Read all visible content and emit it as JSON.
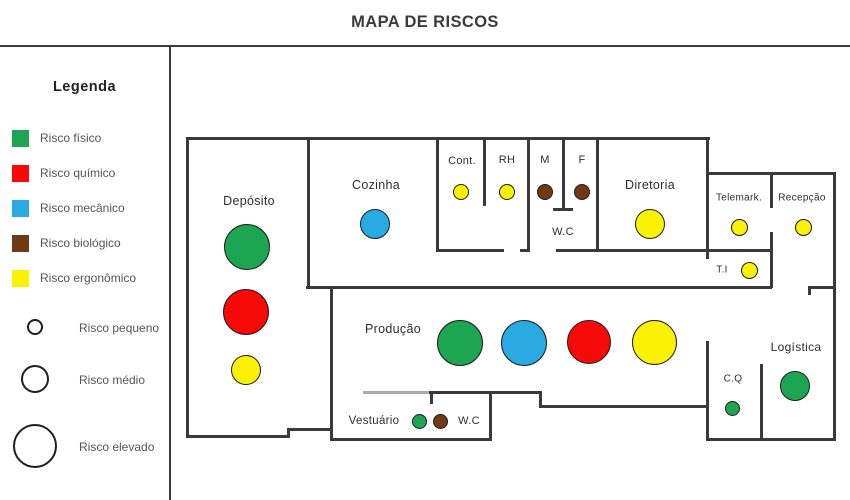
{
  "title": "MAPA DE RISCOS",
  "legend": {
    "heading": "Legenda",
    "risk_types": [
      {
        "id": "fisico",
        "label": "Risco físico",
        "color": "#1ea551"
      },
      {
        "id": "quimico",
        "label": "Risco químico",
        "color": "#f60909"
      },
      {
        "id": "mecanico",
        "label": "Risco mecânico",
        "color": "#29abe2"
      },
      {
        "id": "biologico",
        "label": "Risco biológico",
        "color": "#6f3a14"
      },
      {
        "id": "ergonomico",
        "label": "Risco ergonômico",
        "color": "#fbf104"
      }
    ],
    "risk_sizes": [
      {
        "id": "pequeno",
        "label": "Risco pequeno"
      },
      {
        "id": "medio",
        "label": "Risco médio"
      },
      {
        "id": "elevado",
        "label": "Risco elevado"
      }
    ]
  },
  "map": {
    "rooms": [
      {
        "id": "deposito",
        "label": "Depósito",
        "risks": [
          {
            "type": "fisico",
            "size": "elevado"
          },
          {
            "type": "quimico",
            "size": "elevado"
          },
          {
            "type": "ergonomico",
            "size": "medio"
          }
        ]
      },
      {
        "id": "cozinha",
        "label": "Cozinha",
        "risks": [
          {
            "type": "mecanico",
            "size": "medio"
          }
        ]
      },
      {
        "id": "cont",
        "label": "Cont.",
        "risks": [
          {
            "type": "ergonomico",
            "size": "pequeno"
          }
        ]
      },
      {
        "id": "rh",
        "label": "RH",
        "risks": [
          {
            "type": "ergonomico",
            "size": "pequeno"
          }
        ]
      },
      {
        "id": "m",
        "label": "M",
        "risks": [
          {
            "type": "biologico",
            "size": "pequeno"
          }
        ]
      },
      {
        "id": "f",
        "label": "F",
        "risks": [
          {
            "type": "biologico",
            "size": "pequeno"
          }
        ]
      },
      {
        "id": "wc_top",
        "label": "W.C",
        "risks": []
      },
      {
        "id": "diretoria",
        "label": "Diretoria",
        "risks": [
          {
            "type": "ergonomico",
            "size": "medio"
          }
        ]
      },
      {
        "id": "telemark",
        "label": "Telemark.",
        "risks": [
          {
            "type": "ergonomico",
            "size": "pequeno"
          }
        ]
      },
      {
        "id": "recepcao",
        "label": "Recepção",
        "risks": [
          {
            "type": "ergonomico",
            "size": "pequeno"
          }
        ]
      },
      {
        "id": "ti",
        "label": "T.I",
        "risks": [
          {
            "type": "ergonomico",
            "size": "pequeno"
          }
        ]
      },
      {
        "id": "producao",
        "label": "Produção",
        "risks": [
          {
            "type": "fisico",
            "size": "elevado"
          },
          {
            "type": "mecanico",
            "size": "elevado"
          },
          {
            "type": "quimico",
            "size": "elevado"
          },
          {
            "type": "ergonomico",
            "size": "elevado"
          }
        ]
      },
      {
        "id": "logistica",
        "label": "Logística",
        "risks": [
          {
            "type": "fisico",
            "size": "medio"
          }
        ]
      },
      {
        "id": "cq",
        "label": "C.Q",
        "risks": [
          {
            "type": "fisico",
            "size": "pequeno"
          }
        ]
      },
      {
        "id": "vestuario",
        "label": "Vestuário",
        "risks": [
          {
            "type": "fisico",
            "size": "pequeno"
          },
          {
            "type": "biologico",
            "size": "pequeno"
          }
        ]
      },
      {
        "id": "wc_bottom",
        "label": "W.C",
        "risks": []
      }
    ]
  }
}
